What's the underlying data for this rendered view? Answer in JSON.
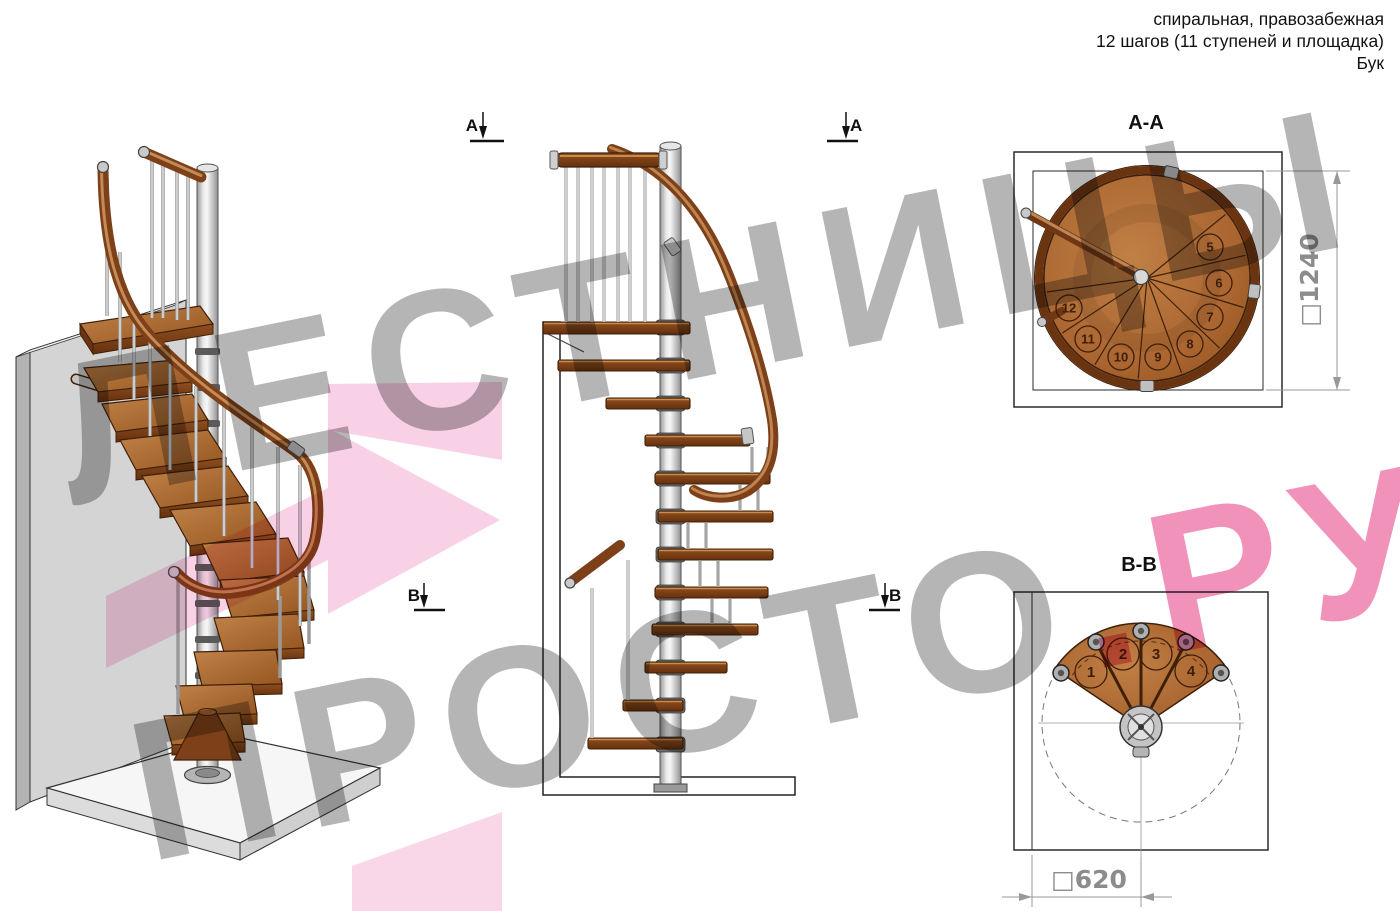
{
  "header": {
    "line1": "спиральная, правозабежная",
    "line2": "12 шагов (11 ступеней и площадка)",
    "line3": "Бук"
  },
  "watermark": {
    "line1": "ЛЕСТНИЦЫ",
    "line2_gray": "ПРОСТО",
    "line2_pink": ".РУ"
  },
  "markers": {
    "a": "A",
    "b": "B"
  },
  "views": {
    "aa": {
      "title": "A-A",
      "dimension": "□1240",
      "steps": [
        "5",
        "6",
        "7",
        "8",
        "9",
        "10",
        "11",
        "12"
      ]
    },
    "bb": {
      "title": "B-B",
      "dimension": "□620",
      "steps": [
        "1",
        "2",
        "3",
        "4"
      ]
    }
  },
  "colors": {
    "wood": "#a8622e",
    "wood_dark": "#6b3410",
    "metal": "#c9c9c9",
    "accent_pink": "#ef7fae",
    "dim_gray": "#8c8c8c"
  }
}
